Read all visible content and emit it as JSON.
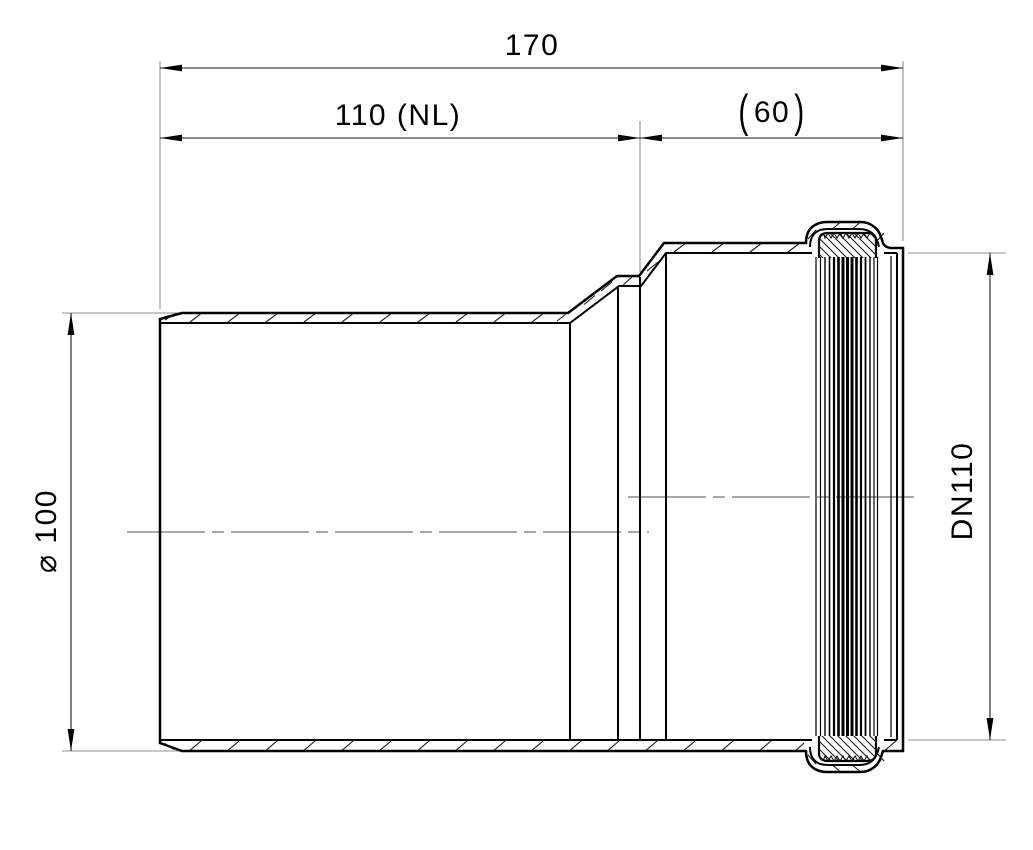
{
  "colors": {
    "background": "#ffffff",
    "outline": "#000000",
    "extension_line": "#8f8f8f",
    "centerline": "#757575"
  },
  "dimensions": {
    "total_length": {
      "label": "170"
    },
    "pipe_length": {
      "label": "110 (NL)"
    },
    "socket_depth": {
      "open_paren": "(",
      "value": "60",
      "close_paren": ")"
    },
    "spigot_diameter": {
      "label": "⌀ 100"
    },
    "socket_bore": {
      "label": "DN110"
    }
  }
}
